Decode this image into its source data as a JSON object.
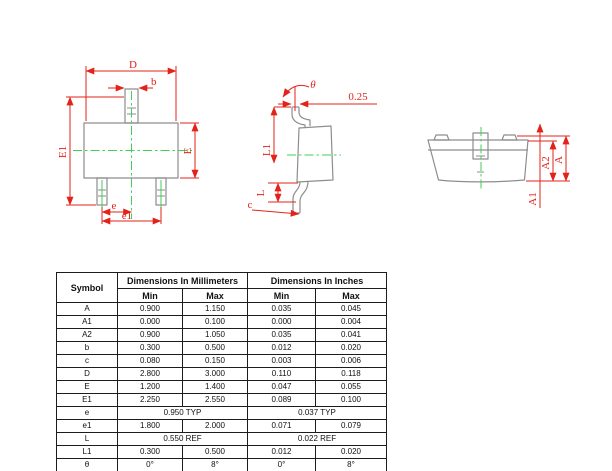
{
  "colors": {
    "dimension_red": "#e2231a",
    "outline_gray": "#8d8d8d",
    "centerline_green": "#41cf57",
    "table_border": "#1c1c1c",
    "background": "#ffffff"
  },
  "labels": {
    "top_view": {
      "D": "D",
      "b": "b",
      "E1": "E1",
      "E": "E",
      "e": "e",
      "e1": "e1"
    },
    "side_view": {
      "theta": "θ",
      "offset": "0.25",
      "L1": "L1",
      "L": "L",
      "c": "c"
    },
    "front_view": {
      "A": "A",
      "A1": "A1",
      "A2": "A2"
    }
  },
  "table": {
    "header": {
      "symbol": "Symbol",
      "mm": "Dimensions In Millimeters",
      "inches": "Dimensions In Inches",
      "min": "Min",
      "max": "Max"
    },
    "rows": [
      {
        "symbol": "A",
        "mm_min": "0.900",
        "mm_max": "1.150",
        "in_min": "0.035",
        "in_max": "0.045"
      },
      {
        "symbol": "A1",
        "mm_min": "0.000",
        "mm_max": "0.100",
        "in_min": "0.000",
        "in_max": "0.004"
      },
      {
        "symbol": "A2",
        "mm_min": "0.900",
        "mm_max": "1.050",
        "in_min": "0.035",
        "in_max": "0.041"
      },
      {
        "symbol": "b",
        "mm_min": "0.300",
        "mm_max": "0.500",
        "in_min": "0.012",
        "in_max": "0.020"
      },
      {
        "symbol": "c",
        "mm_min": "0.080",
        "mm_max": "0.150",
        "in_min": "0.003",
        "in_max": "0.006"
      },
      {
        "symbol": "D",
        "mm_min": "2.800",
        "mm_max": "3.000",
        "in_min": "0.110",
        "in_max": "0.118"
      },
      {
        "symbol": "E",
        "mm_min": "1.200",
        "mm_max": "1.400",
        "in_min": "0.047",
        "in_max": "0.055"
      },
      {
        "symbol": "E1",
        "mm_min": "2.250",
        "mm_max": "2.550",
        "in_min": "0.089",
        "in_max": "0.100"
      },
      {
        "symbol": "e",
        "mm_span": "0.950 TYP",
        "in_span": "0.037 TYP"
      },
      {
        "symbol": "e1",
        "mm_min": "1.800",
        "mm_max": "2.000",
        "in_min": "0.071",
        "in_max": "0.079"
      },
      {
        "symbol": "L",
        "mm_span": "0.550 REF",
        "in_span": "0.022 REF"
      },
      {
        "symbol": "L1",
        "mm_min": "0.300",
        "mm_max": "0.500",
        "in_min": "0.012",
        "in_max": "0.020"
      },
      {
        "symbol": "θ",
        "mm_min": "0°",
        "mm_max": "8°",
        "in_min": "0°",
        "in_max": "8°"
      }
    ]
  }
}
